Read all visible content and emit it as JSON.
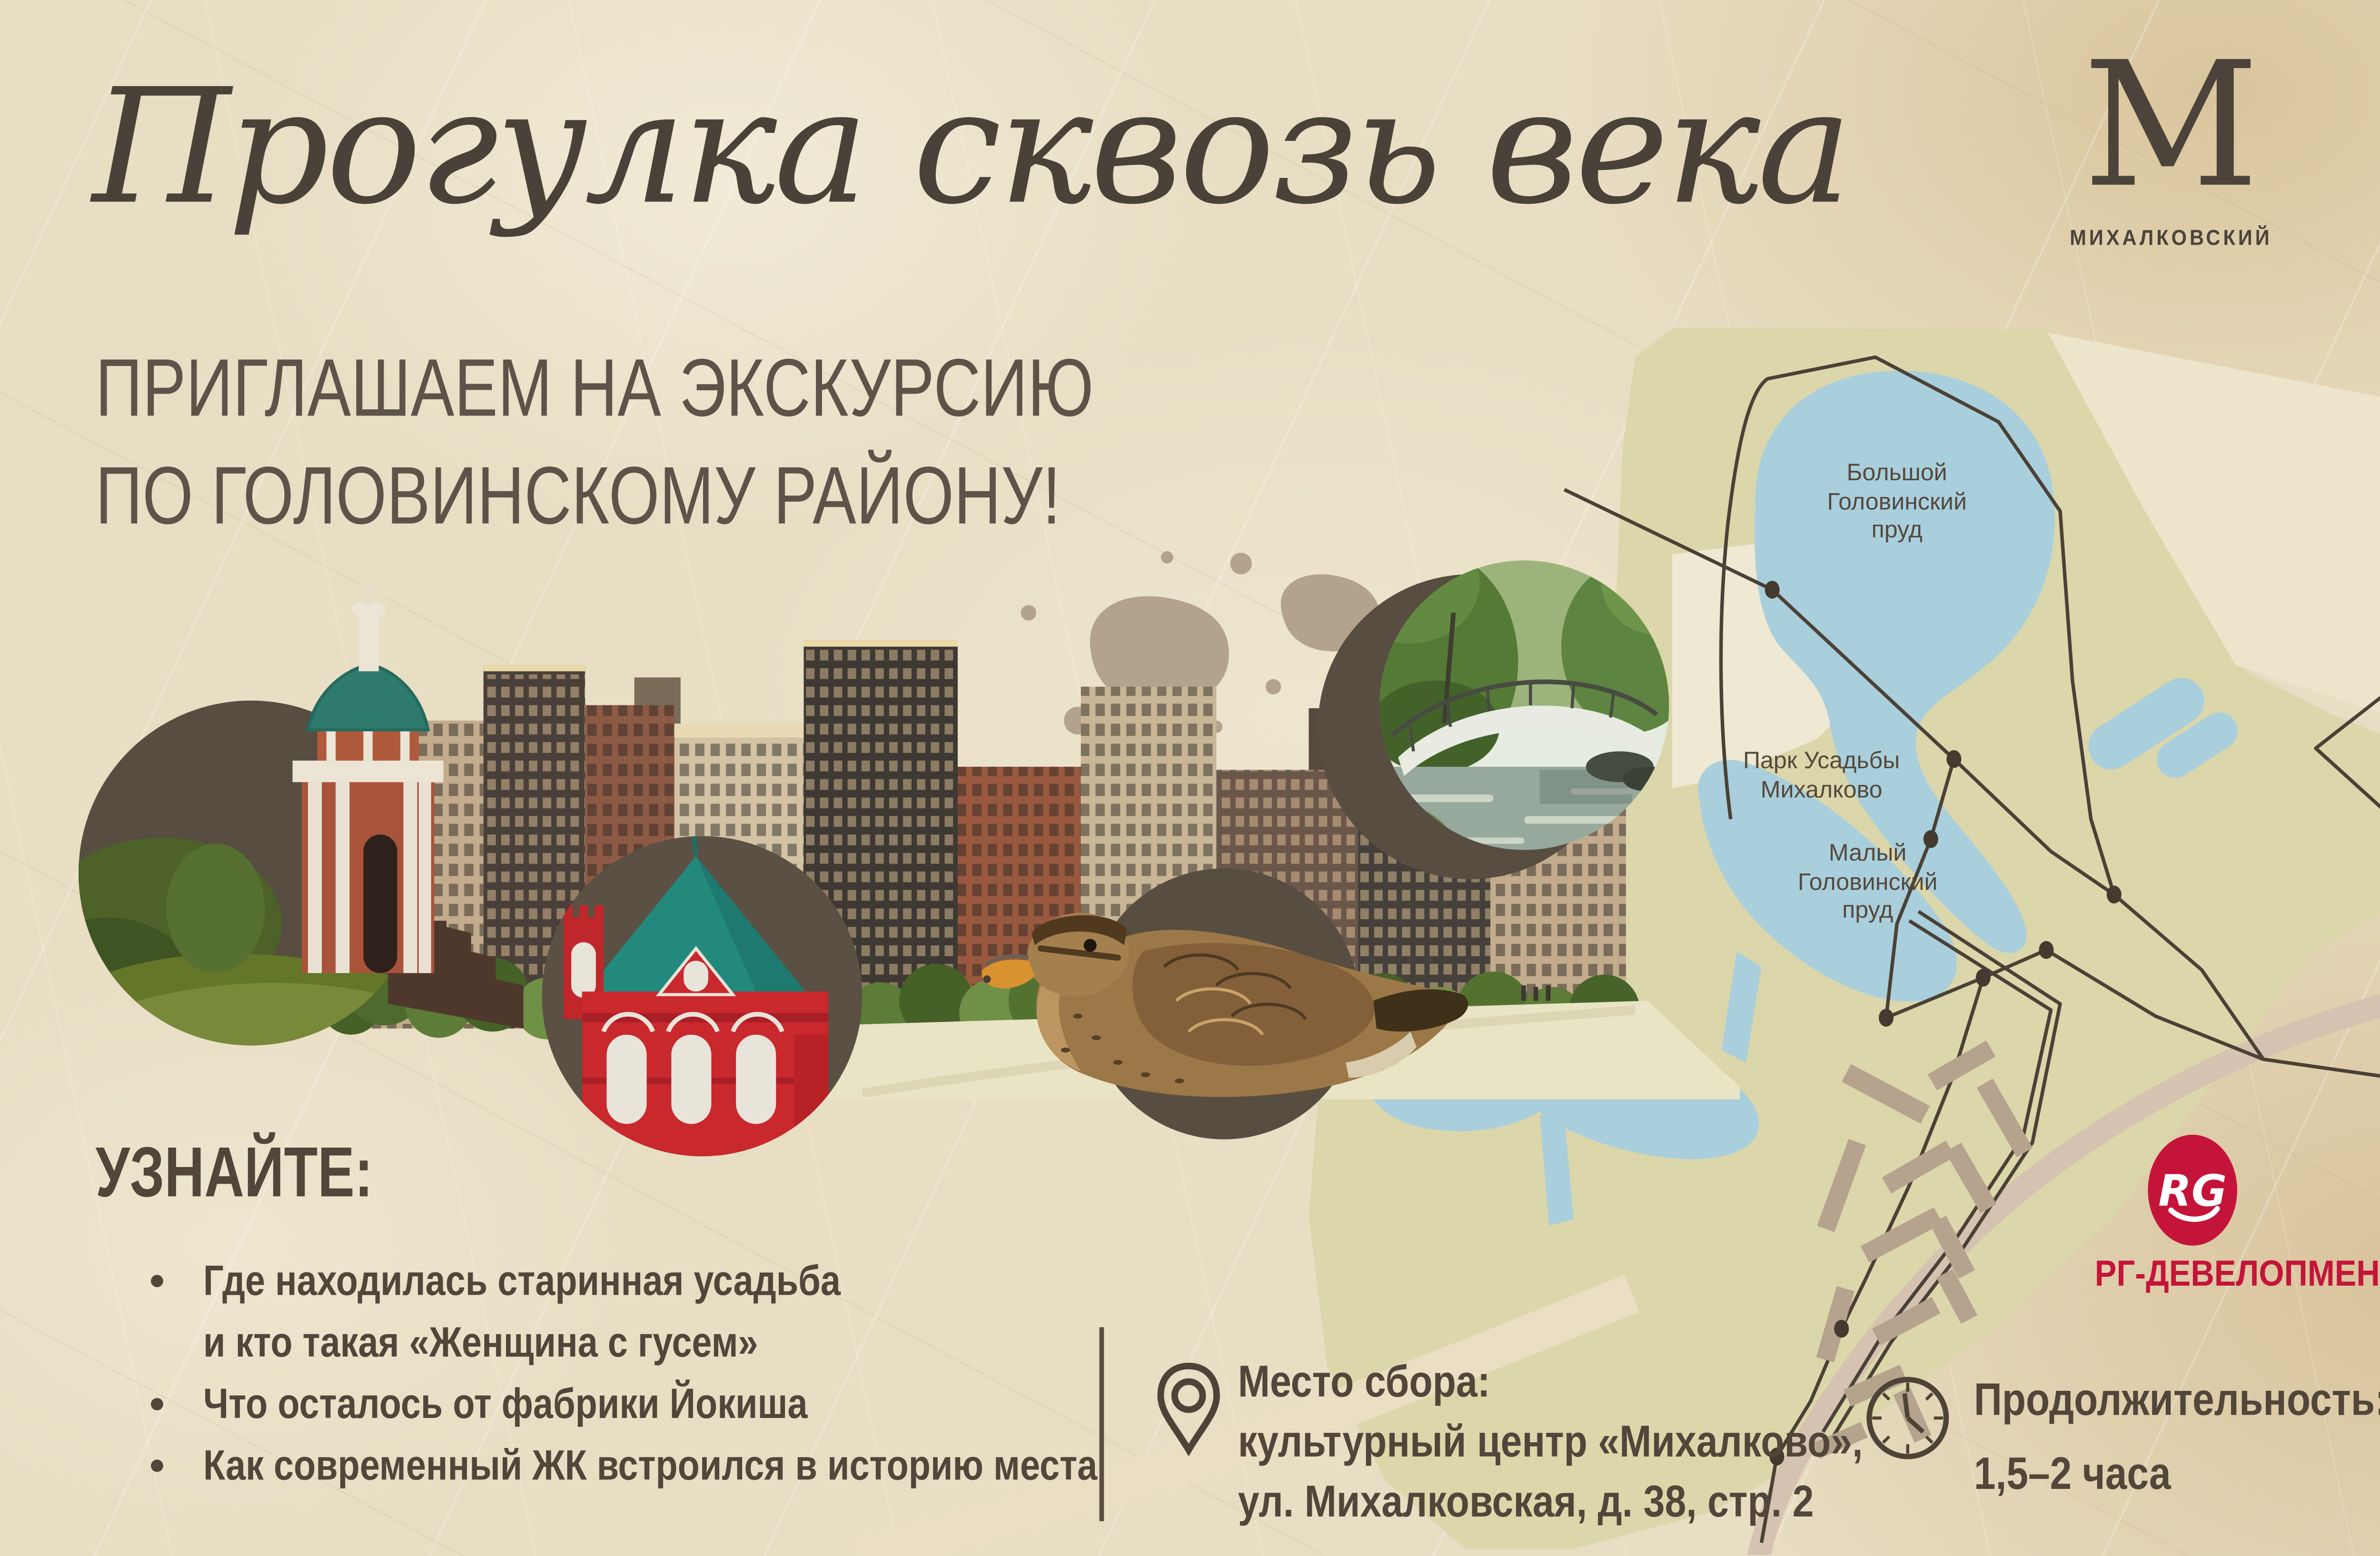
{
  "title": "Прогулка сквозь века",
  "brand": {
    "letter": "М",
    "name": "МИХАЛКОВСКИЙ"
  },
  "subtitle": {
    "line1": "ПРИГЛАШАЕМ НА ЭКСКУРСИЮ",
    "line2": "ПО ГОЛОВИНСКОМУ РАЙОНУ!"
  },
  "map": {
    "pond_big": {
      "line1": "Большой",
      "line2": "Головинский",
      "line3": "пруд"
    },
    "park": {
      "line1": "Парк Усадьбы",
      "line2": "Михалково"
    },
    "pond_small": {
      "line1": "Малый",
      "line2": "Головинский",
      "line3": "пруд"
    }
  },
  "learn": {
    "heading": "УЗНАЙТЕ:",
    "bullet1_line1": "Где находилась старинная усадьба",
    "bullet1_line2": "и кто такая «Женщина с гусем»",
    "bullet2": "Что осталось от фабрики Йокиша",
    "bullet3": "Как современный ЖК встроился в историю места"
  },
  "meeting": {
    "title": "Место сбора:",
    "line1": "культурный центр «Михалково»,",
    "line2": "ул. Михалковская, д. 38, стр. 2"
  },
  "duration": {
    "title": "Продолжительность:",
    "value": "1,5–2 часа"
  },
  "developer": {
    "initials": "RG",
    "name": "РГ-ДЕВЕЛОПМЕНТ"
  },
  "colors": {
    "accent_red": "#c41439",
    "paper": "#e8dec4",
    "ink": "#4c443a",
    "map_park": "#dcd6ab",
    "map_water": "#a9cfdd"
  }
}
